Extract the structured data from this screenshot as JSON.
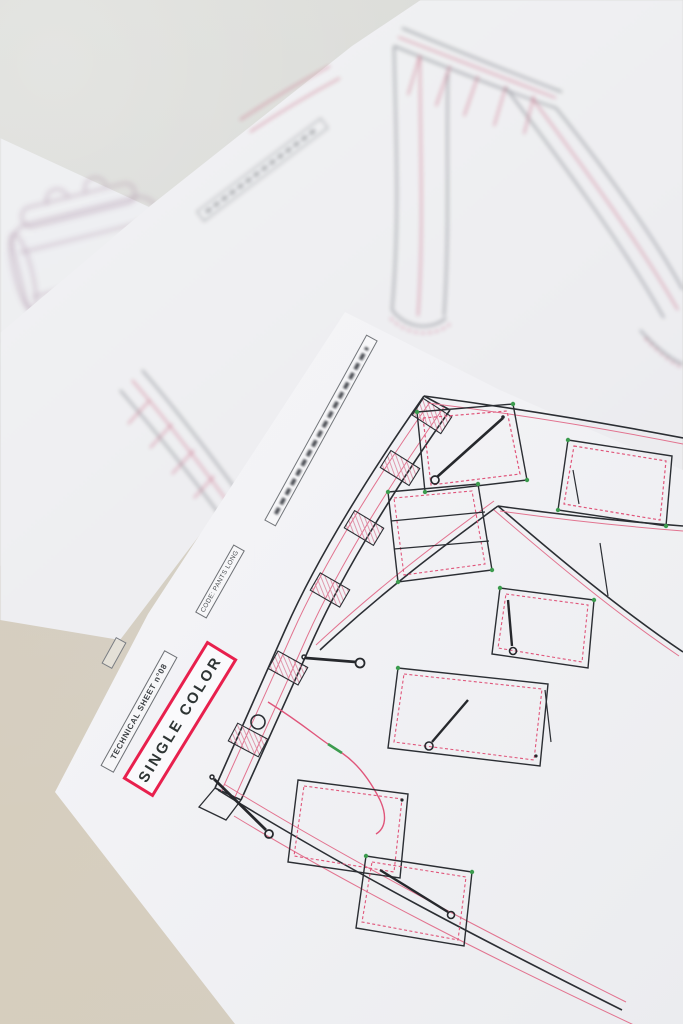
{
  "scene": {
    "description": "Photograph of fashion technical-drawing sheets lying on a desk",
    "desk_top_color": "#d9dad6",
    "desk_bottom_color": "#d6cfc0"
  },
  "foreground_sheet": {
    "title_box_label": "TECHNICAL SHEET n°08",
    "variant_label": "SINGLE COLOR",
    "code_label": "CODE: PANTS LONG",
    "subject": "cargo trousers front flat sketch with zip pockets",
    "colors": {
      "accent_red": "#e8204d",
      "outline": "#2b2e33",
      "stitch_pink": "#e0557a",
      "zipper_green": "#3c9b4e",
      "paper": "#f4f4f7"
    }
  },
  "background_sheets": {
    "top_sheet_subject": "trouser flat sketches, out of focus",
    "left_sheet_subject": "bag and belt sketches, out of focus"
  }
}
